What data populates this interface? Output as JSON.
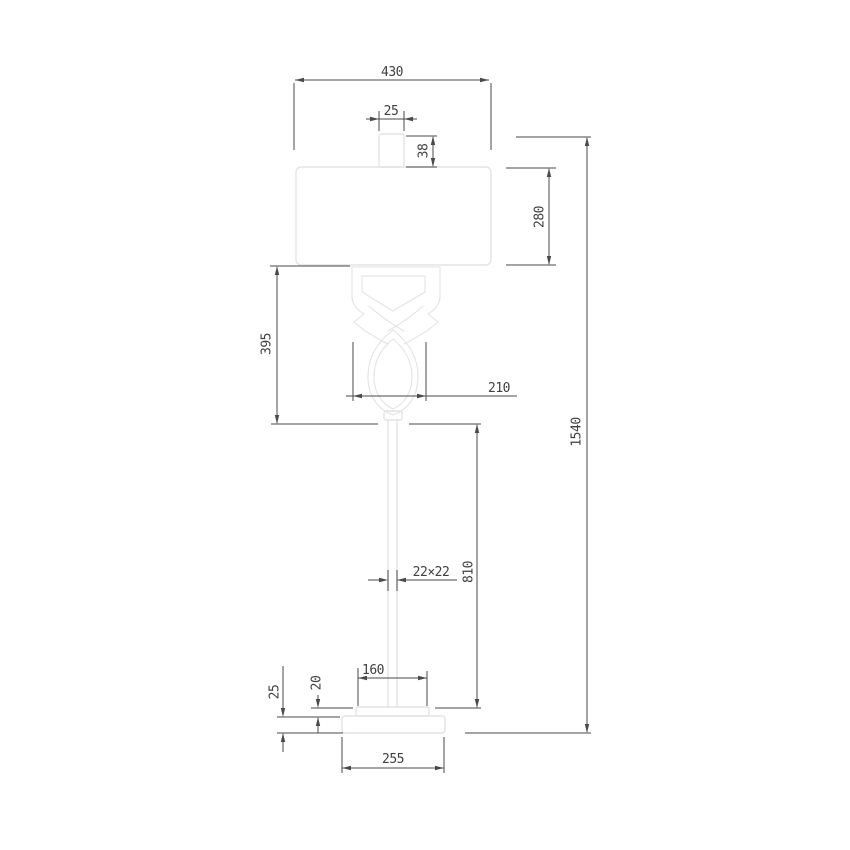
{
  "dimensions": {
    "shade_width": "430",
    "finial_width": "25",
    "finial_height": "38",
    "shade_height": "280",
    "decoration_height": "395",
    "decoration_width": "210",
    "total_height": "1540",
    "pole_cross_section": "22×22",
    "pole_height": "810",
    "base_plate_width": "160",
    "base_plate_height": "20",
    "base_ring_height": "25",
    "base_width": "255"
  },
  "colors": {
    "background": "#ffffff",
    "product_outline": "#e3e3e3",
    "dimension_lines": "#4a4a4a",
    "dimension_text": "#404040"
  }
}
